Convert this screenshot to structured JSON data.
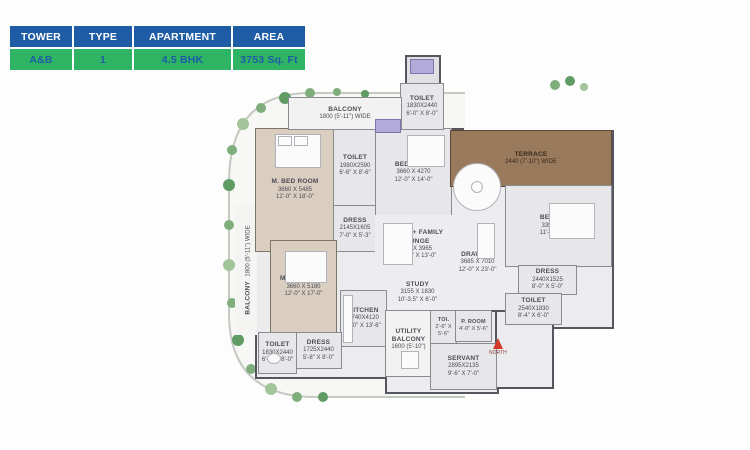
{
  "info_table": {
    "cols": [
      {
        "header": "TOWER",
        "value": "A&B"
      },
      {
        "header": "TYPE",
        "value": "1"
      },
      {
        "header": "APARTMENT",
        "value": "4.5 BHK"
      },
      {
        "header": "AREA",
        "value": "3753 Sq. Ft"
      }
    ],
    "header_bg": "#1e5ca6",
    "value_bg": "#2fb464",
    "value_text": "#1e5ca6"
  },
  "floor_plan": {
    "north_label": "NORTH",
    "colors": {
      "wall": "#56565e",
      "floor": "#ececee",
      "master_bedroom_floor": "#d9cec0",
      "terrace_floor": "#9a7a5c",
      "plants": "#7fae7c",
      "north_arrow": "#d43a2a"
    },
    "rooms": [
      {
        "name": "M. BED ROOM",
        "dim_mm": "3660 X 5485",
        "dim_ft": "12'-0\" X 18'-0\""
      },
      {
        "name": "TOILET",
        "dim_mm": "1980X2590",
        "dim_ft": "6'-6\" X 8'-6\""
      },
      {
        "name": "DRESS",
        "dim_mm": "2145X1605",
        "dim_ft": "7'-0\" X 5'-3\""
      },
      {
        "name": "BED ROOM",
        "dim_mm": "3660 X 4270",
        "dim_ft": "12'-0\" X 14'-0\""
      },
      {
        "name": "TOILET",
        "dim_mm": "1830X2440",
        "dim_ft": "6'-0\" X 8'-0\""
      },
      {
        "name": "BALCONY",
        "dim_mm": "1800 (5'-11\") WIDE"
      },
      {
        "name": "TERRACE",
        "dim_mm": "2440 (7'-10\") WIDE"
      },
      {
        "name": "BED ROOM",
        "dim_mm": "3350 X 4270",
        "dim_ft": "11'-0\" X 14'-0\""
      },
      {
        "name": "DRESS",
        "dim_mm": "2440X1525",
        "dim_ft": "8'-0\" X 5'-0\""
      },
      {
        "name": "TOILET",
        "dim_mm": "2540X1830",
        "dim_ft": "8'-4\" X 6'-0\""
      },
      {
        "name": "DINING + FAMILY LOUNGE",
        "dim_mm": "5955 X 3965",
        "dim_ft": "19'-6.5\" X 13'-0\""
      },
      {
        "name": "DRAWING",
        "dim_mm": "3685 X 7010",
        "dim_ft": "12'-0\" X 23'-0\""
      },
      {
        "name": "STUDY",
        "dim_mm": "3155 X 1830",
        "dim_ft": "10'-3.5\" X 6'-0\""
      },
      {
        "name": "KITCHEN",
        "dim_mm": "2740X4120",
        "dim_ft": "9'-0\" X 13'-6\""
      },
      {
        "name": "UTILITY BALCONY",
        "dim_mm": "1600 (5'-10\") WIDE"
      },
      {
        "name": "TOI.",
        "dim_mm": "2'-6\" X 5'-6\""
      },
      {
        "name": "P. ROOM",
        "dim_mm": "4'-0\" X 5'-6\""
      },
      {
        "name": "SERVANT",
        "dim_mm": "2895X2135",
        "dim_ft": "9'-6\" X 7'-0\""
      },
      {
        "name": "M. BED ROOM",
        "dim_mm": "3660 X 5180",
        "dim_ft": "12'-0\" X 17'-0\""
      },
      {
        "name": "DRESS",
        "dim_mm": "1725X2440",
        "dim_ft": "5'-8\" X 8'-0\""
      },
      {
        "name": "TOILET",
        "dim_mm": "1830X2440",
        "dim_ft": "6'-0\" X 8'-0\""
      },
      {
        "name": "BALCONY",
        "dim_mm": "1800 (5'-11\") WIDE"
      }
    ]
  }
}
